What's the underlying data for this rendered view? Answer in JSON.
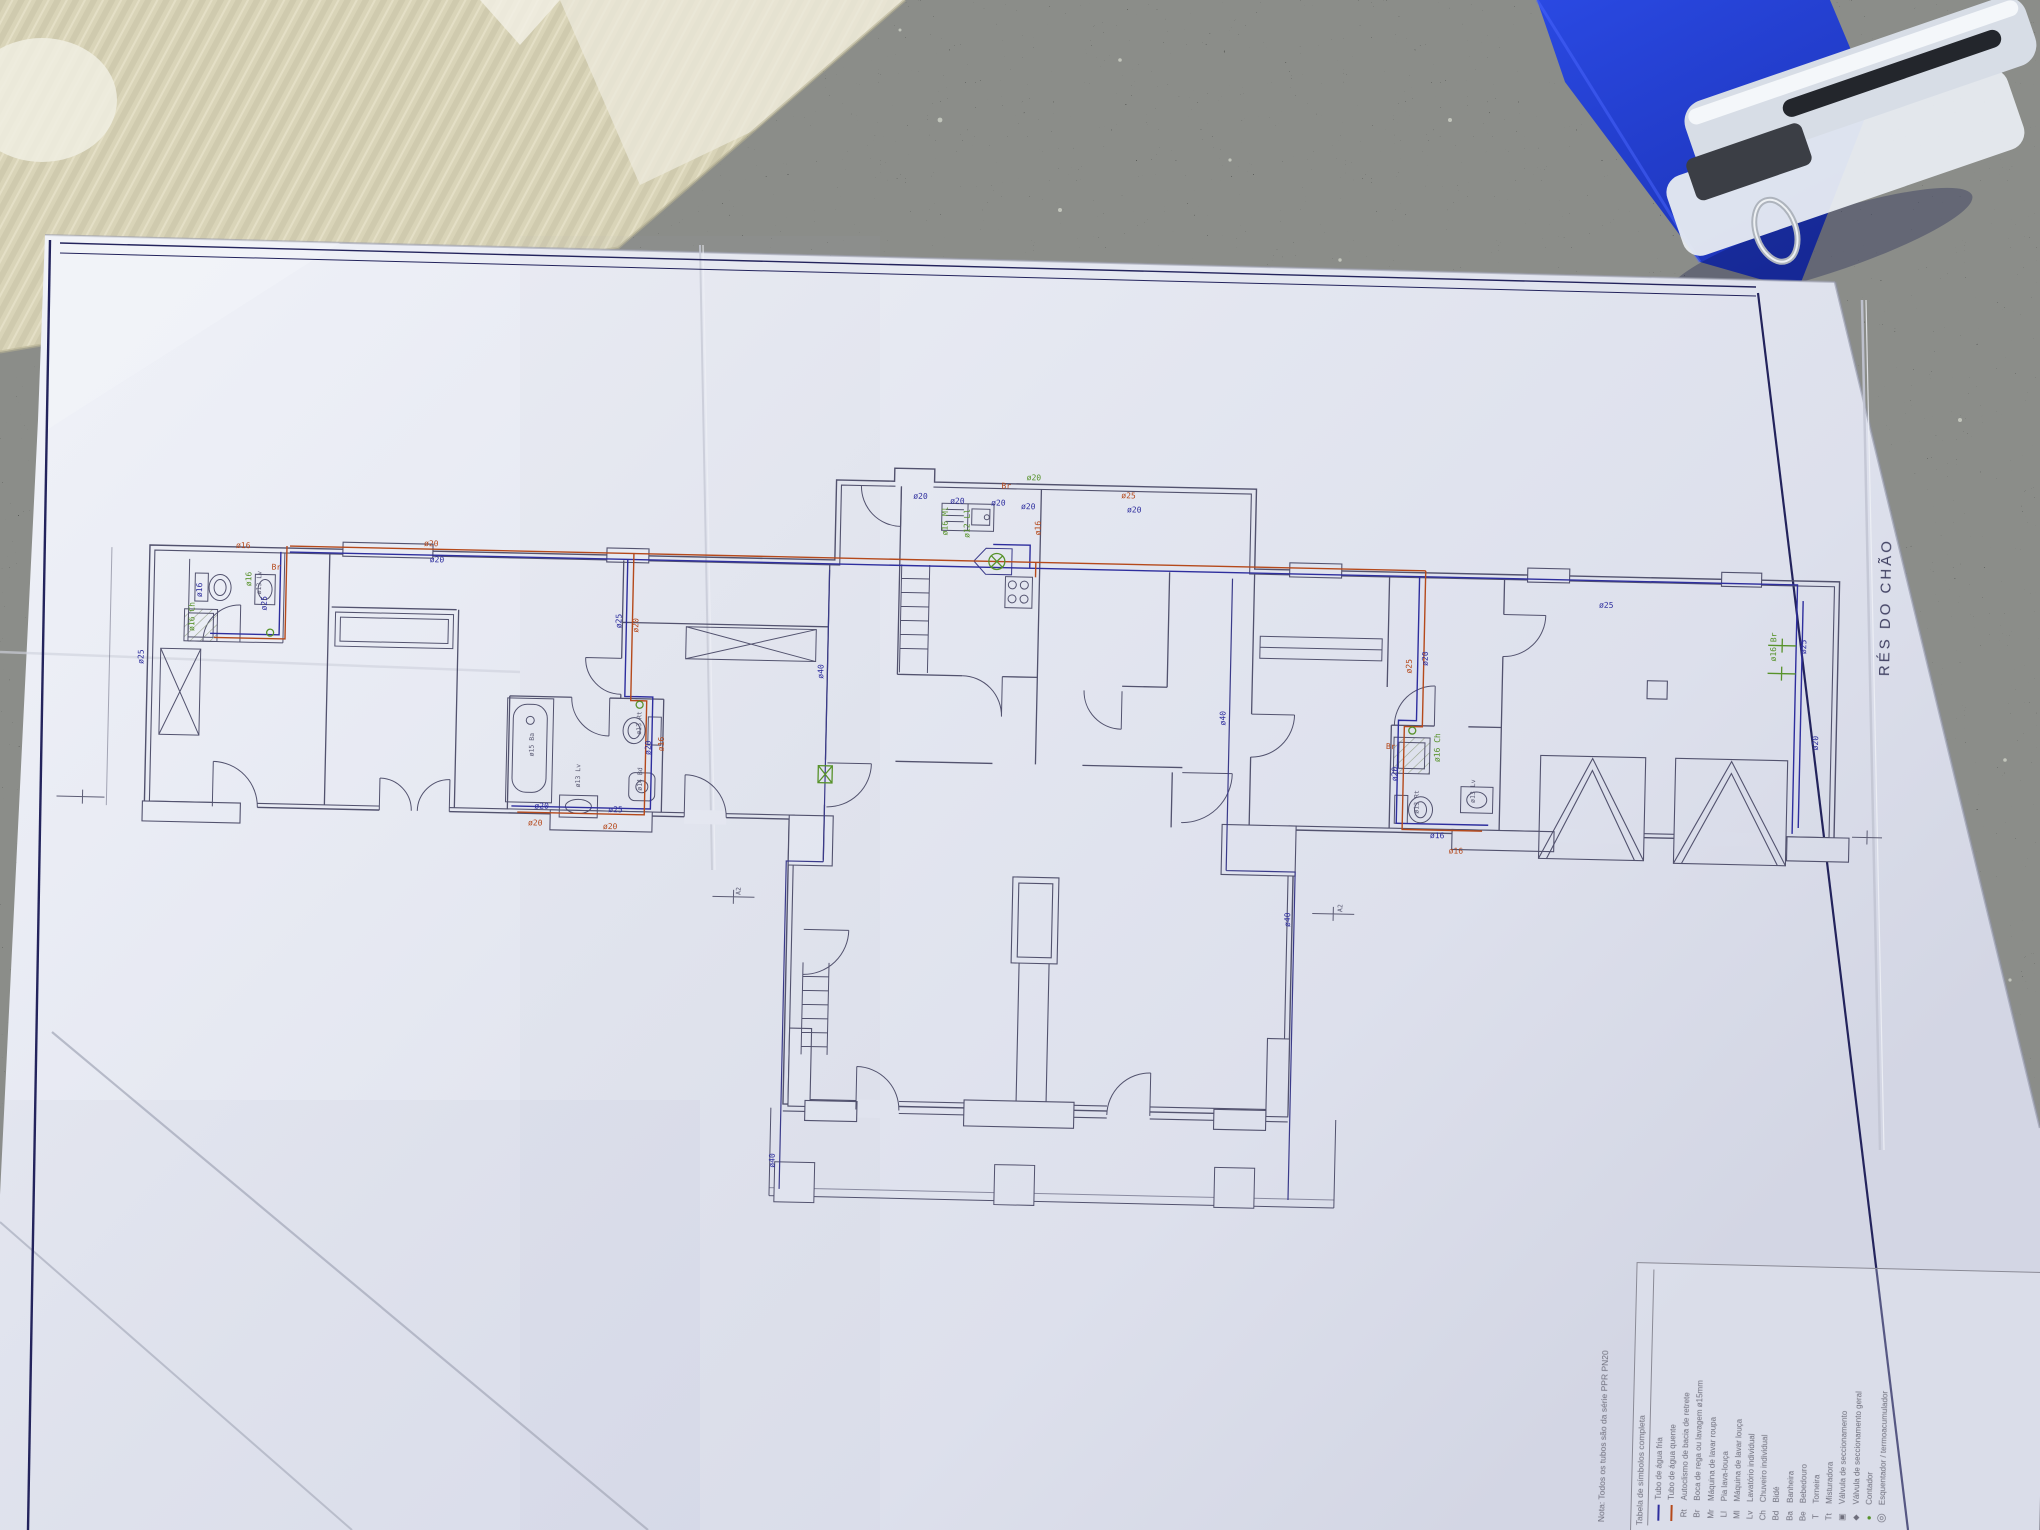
{
  "photo": {
    "surfaces": {
      "countertop_color": "#2c2e2b",
      "cardboard_color": "#d9d4b8",
      "folder_color": "#1e3ed8",
      "paper_color": "#e8eaf2"
    },
    "objects": [
      "granite-countertop",
      "corrugated-cardboard",
      "blue-folder",
      "white-stapler",
      "blueprint-paper"
    ]
  },
  "drawing": {
    "title": "RÉS DO CHÃO",
    "note": "Nota:  Todos os tubos são da série PPR PN20",
    "colors": {
      "cold": "#2e2e9e",
      "hot": "#b5491b",
      "fitting": "#57922a",
      "line": "#52526e",
      "frame": "#23235c",
      "dark_label": "#5c5c74"
    },
    "legend": {
      "header": "Tabela de símbolos completa",
      "rows": [
        {
          "sym": "",
          "type": "line-cold",
          "label": "Tubo de água fria"
        },
        {
          "sym": "",
          "type": "line-hot",
          "label": "Tubo de água quente"
        },
        {
          "sym": "Rt",
          "type": "abbr",
          "label": "Autoclismo de bacia de retrete"
        },
        {
          "sym": "Br",
          "type": "abbr",
          "label": "Boca de rega ou lavagem ø15mm"
        },
        {
          "sym": "Mr",
          "type": "abbr",
          "label": "Máquina de lavar roupa"
        },
        {
          "sym": "Ll",
          "type": "abbr",
          "label": "Pia lava-louça"
        },
        {
          "sym": "Ml",
          "type": "abbr",
          "label": "Máquina de lavar louça"
        },
        {
          "sym": "Lv",
          "type": "abbr",
          "label": "Lavatório individual"
        },
        {
          "sym": "Ch",
          "type": "abbr",
          "label": "Chuveiro individual"
        },
        {
          "sym": "Bd",
          "type": "abbr",
          "label": "Bidé"
        },
        {
          "sym": "Ba",
          "type": "abbr",
          "label": "Banheira"
        },
        {
          "sym": "Be",
          "type": "abbr",
          "label": "Bebedouro"
        },
        {
          "sym": "T",
          "type": "abbr",
          "label": "Torneira"
        },
        {
          "sym": "Tt",
          "type": "abbr",
          "label": "Misturadora"
        },
        {
          "sym": "▣",
          "type": "glyph",
          "label": "Válvula de seccionamento"
        },
        {
          "sym": "◆",
          "type": "glyph",
          "label": "Válvula de seccionamento geral"
        },
        {
          "sym": "●",
          "type": "glyph-green",
          "label": "Contador"
        },
        {
          "sym": "◎",
          "type": "glyph-big",
          "label": "Esquentador / termoacumulador"
        }
      ]
    },
    "annotations": [
      {
        "t": "ø16",
        "c": "r",
        "x": 236,
        "y": 546
      },
      {
        "t": "ø20",
        "c": "r",
        "x": 424,
        "y": 540
      },
      {
        "t": "ø20",
        "c": "b",
        "x": 430,
        "y": 556
      },
      {
        "t": "Br",
        "c": "r",
        "x": 272,
        "y": 567
      },
      {
        "t": "ø25",
        "c": "b",
        "x": 268,
        "y": 608,
        "r": -90
      },
      {
        "t": "ø16",
        "c": "b",
        "x": 203,
        "y": 596,
        "r": -90
      },
      {
        "t": "ø13 Lv",
        "c": "d",
        "x": 262,
        "y": 592,
        "r": -90
      },
      {
        "t": "ø16 Ch",
        "c": "g",
        "x": 196,
        "y": 630,
        "r": -90
      },
      {
        "t": "ø16",
        "c": "g",
        "x": 252,
        "y": 584,
        "r": -90
      },
      {
        "t": "ø25",
        "c": "b",
        "x": 146,
        "y": 664,
        "r": -90
      },
      {
        "t": "ø25",
        "c": "b",
        "x": 623,
        "y": 618,
        "r": -90
      },
      {
        "t": "ø20",
        "c": "r",
        "x": 640,
        "y": 622,
        "r": -90
      },
      {
        "t": "ø20",
        "c": "b",
        "x": 655,
        "y": 744,
        "r": -90
      },
      {
        "t": "ø16",
        "c": "r",
        "x": 668,
        "y": 740,
        "r": -90
      },
      {
        "t": "ø15 Ba",
        "c": "d",
        "x": 538,
        "y": 748,
        "r": -90
      },
      {
        "t": "ø13 Rt",
        "c": "d",
        "x": 645,
        "y": 724,
        "r": -90
      },
      {
        "t": "ø14 Bd",
        "c": "d",
        "x": 647,
        "y": 780,
        "r": -90
      },
      {
        "t": "ø13 Lv",
        "c": "d",
        "x": 585,
        "y": 778,
        "r": -90
      },
      {
        "t": "ø20",
        "c": "b",
        "x": 540,
        "y": 800
      },
      {
        "t": "ø20",
        "c": "r",
        "x": 534,
        "y": 817
      },
      {
        "t": "ø25",
        "c": "b",
        "x": 614,
        "y": 802
      },
      {
        "t": "ø20",
        "c": "r",
        "x": 609,
        "y": 819
      },
      {
        "t": "ø20",
        "c": "b",
        "x": 912,
        "y": 482
      },
      {
        "t": "ø20",
        "c": "b",
        "x": 949,
        "y": 486
      },
      {
        "t": "ø20",
        "c": "b",
        "x": 990,
        "y": 487
      },
      {
        "t": "ø20",
        "c": "b",
        "x": 1020,
        "y": 490
      },
      {
        "t": "Br",
        "c": "r",
        "x": 1000,
        "y": 470
      },
      {
        "t": "ø20",
        "c": "g",
        "x": 1025,
        "y": 461
      },
      {
        "t": "ø16",
        "c": "r",
        "x": 1040,
        "y": 516,
        "r": -90
      },
      {
        "t": "ø16 Ml",
        "c": "g",
        "x": 947,
        "y": 518,
        "r": -90
      },
      {
        "t": "ø12 Ll",
        "c": "g",
        "x": 969,
        "y": 520,
        "r": -90
      },
      {
        "t": "ø25",
        "c": "r",
        "x": 1120,
        "y": 477
      },
      {
        "t": "ø20",
        "c": "b",
        "x": 1126,
        "y": 491
      },
      {
        "t": "ø40",
        "c": "b",
        "x": 826,
        "y": 664,
        "r": -90
      },
      {
        "t": "ø40",
        "c": "b",
        "x": 1229,
        "y": 702,
        "r": -90
      },
      {
        "t": "ø40",
        "c": "b",
        "x": 788,
        "y": 1154,
        "r": -90
      },
      {
        "t": "ø40",
        "c": "b",
        "x": 1298,
        "y": 902,
        "r": -90
      },
      {
        "t": "A2",
        "c": "d",
        "x": 748,
        "y": 882,
        "r": -90
      },
      {
        "t": "A2",
        "c": "d",
        "x": 1350,
        "y": 886,
        "r": -90
      },
      {
        "t": "ø25",
        "c": "b",
        "x": 1600,
        "y": 576
      },
      {
        "t": "ø25",
        "c": "r",
        "x": 1414,
        "y": 646,
        "r": -90
      },
      {
        "t": "ø20",
        "c": "b",
        "x": 1430,
        "y": 638,
        "r": -90
      },
      {
        "t": "Br",
        "c": "r",
        "x": 1390,
        "y": 722
      },
      {
        "t": "ø20",
        "c": "b",
        "x": 1402,
        "y": 754,
        "r": -90
      },
      {
        "t": "ø16 Ch",
        "c": "g",
        "x": 1444,
        "y": 734,
        "r": -90
      },
      {
        "t": "ø13 Rt",
        "c": "d",
        "x": 1424,
        "y": 786,
        "r": -90
      },
      {
        "t": "ø13 Lv",
        "c": "d",
        "x": 1480,
        "y": 774,
        "r": -90
      },
      {
        "t": "ø16",
        "c": "b",
        "x": 1436,
        "y": 810
      },
      {
        "t": "ø16",
        "c": "r",
        "x": 1455,
        "y": 825
      },
      {
        "t": "ø25",
        "c": "b",
        "x": 1808,
        "y": 618,
        "r": -90
      },
      {
        "t": "ø20",
        "c": "b",
        "x": 1822,
        "y": 714,
        "r": -90
      },
      {
        "t": "ø16 Br",
        "c": "g",
        "x": 1778,
        "y": 626,
        "r": -90
      }
    ]
  }
}
